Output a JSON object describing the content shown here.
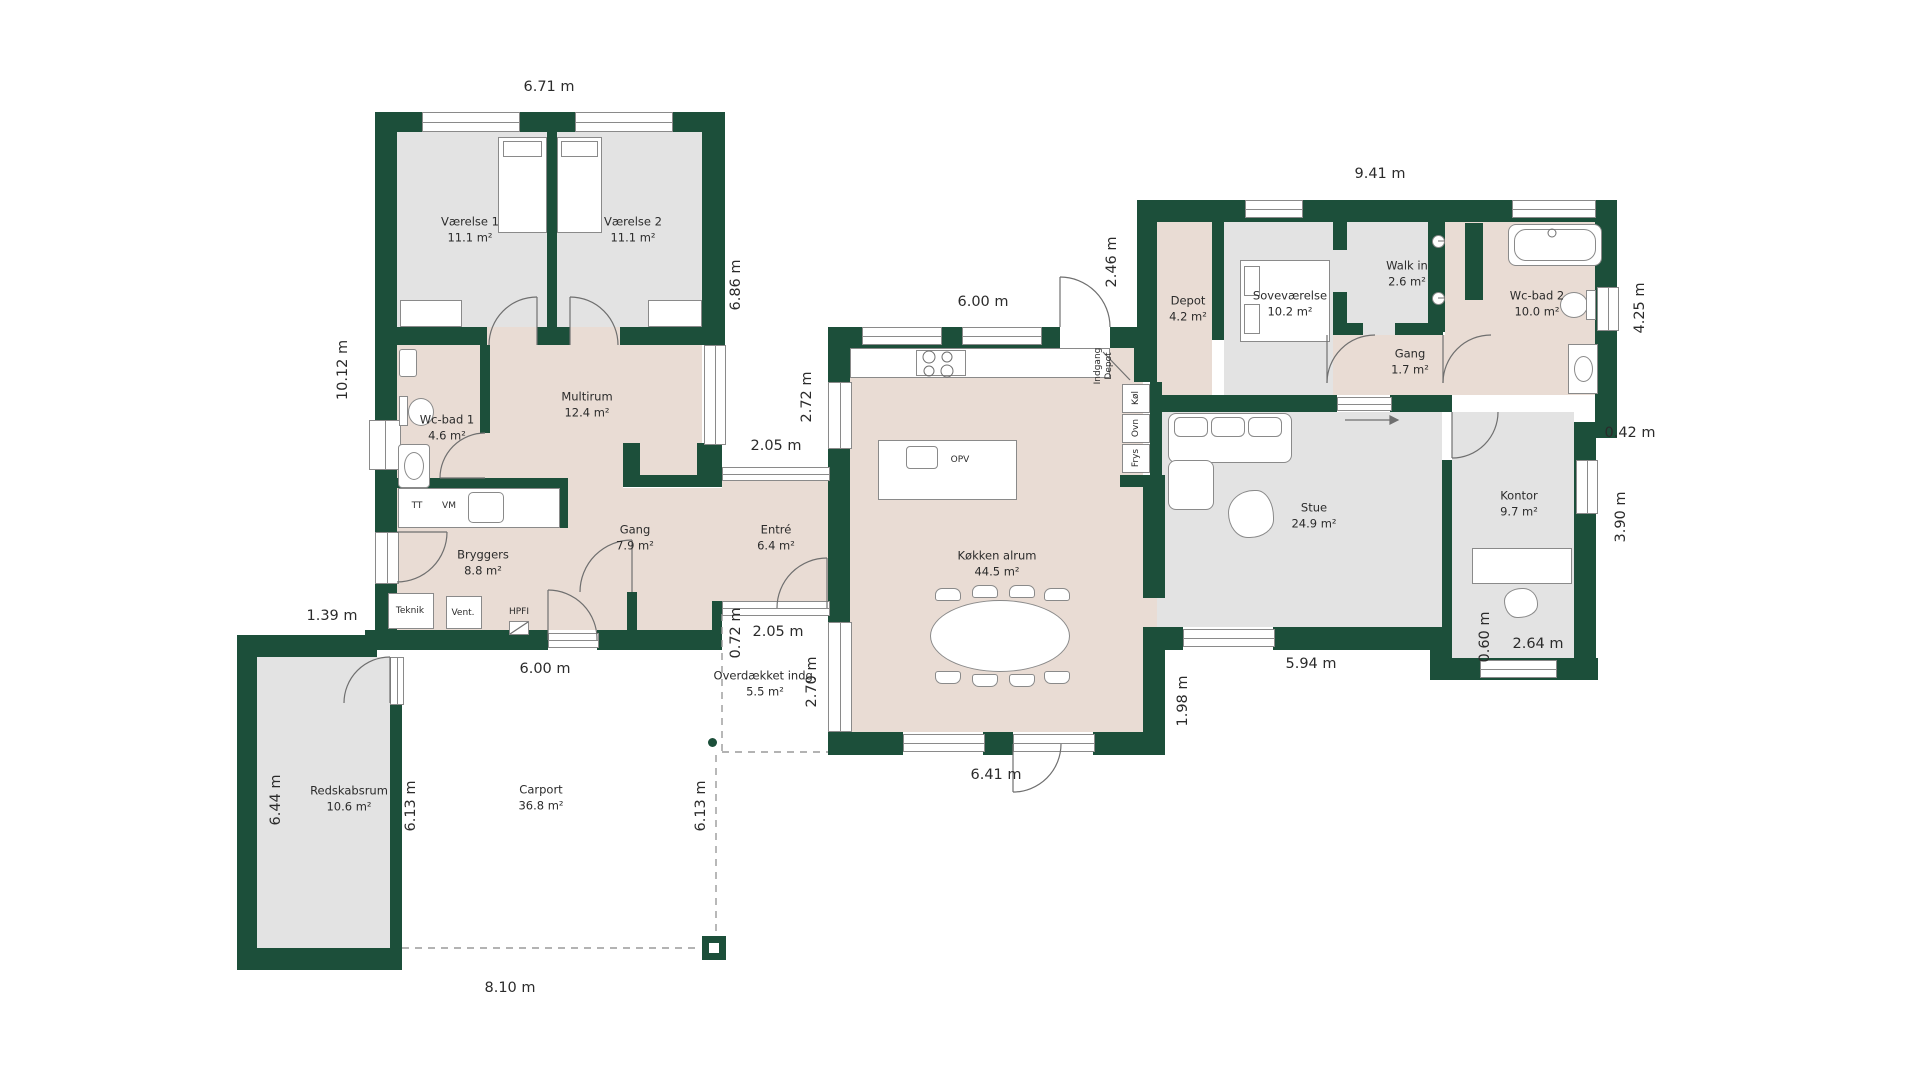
{
  "colors": {
    "wall": "#1c4f3a",
    "warm_floor": "#e9dcd4",
    "cool_floor": "#e3e3e3",
    "line": "#8a8a8a"
  },
  "rooms": [
    {
      "name": "Værelse 1",
      "area": "11.1 m²"
    },
    {
      "name": "Værelse 2",
      "area": "11.1 m²"
    },
    {
      "name": "Wc-bad 1",
      "area": "4.6 m²"
    },
    {
      "name": "Multirum",
      "area": "12.4 m²"
    },
    {
      "name": "Bryggers",
      "area": "8.8 m²"
    },
    {
      "name": "Gang",
      "area": "7.9 m²"
    },
    {
      "name": "Entré",
      "area": "6.4 m²"
    },
    {
      "name": "Køkken alrum",
      "area": "44.5 m²"
    },
    {
      "name": "Depot",
      "area": "4.2 m²"
    },
    {
      "name": "Soveværelse",
      "area": "10.2 m²"
    },
    {
      "name": "Walk in",
      "area": "2.6 m²"
    },
    {
      "name": "Wc-bad 2",
      "area": "10.0 m²"
    },
    {
      "name": "Gang",
      "area": "1.7 m²"
    },
    {
      "name": "Stue",
      "area": "24.9 m²"
    },
    {
      "name": "Kontor",
      "area": "9.7 m²"
    },
    {
      "name": "Overdækket indg.",
      "area": "5.5 m²"
    },
    {
      "name": "Redskabsrum",
      "area": "10.6 m²"
    },
    {
      "name": "Carport",
      "area": "36.8 m²"
    }
  ],
  "dims": [
    "6.71 m",
    "10.12 m",
    "6.86 m",
    "9.41 m",
    "2.46 m",
    "6.00 m",
    "2.05 m",
    "2.72 m",
    "4.25 m",
    "0.42 m",
    "3.90 m",
    "1.39 m",
    "6.00 m",
    "0.72 m",
    "2.05 m",
    "2.70 m",
    "1.98 m",
    "5.94 m",
    "0.60 m",
    "2.64 m",
    "6.41 m",
    "6.44 m",
    "6.13 m",
    "6.13 m",
    "8.10 m"
  ],
  "fixtures": {
    "tt": "TT",
    "vm": "VM",
    "teknik": "Teknik",
    "vent": "Vent.",
    "hpfi": "HPFI",
    "opv": "OPV",
    "kol": "Køl",
    "ovn": "Ovn",
    "frys": "Frys",
    "indgang_line1": "Indgang",
    "indgang_line2": "Depot"
  }
}
